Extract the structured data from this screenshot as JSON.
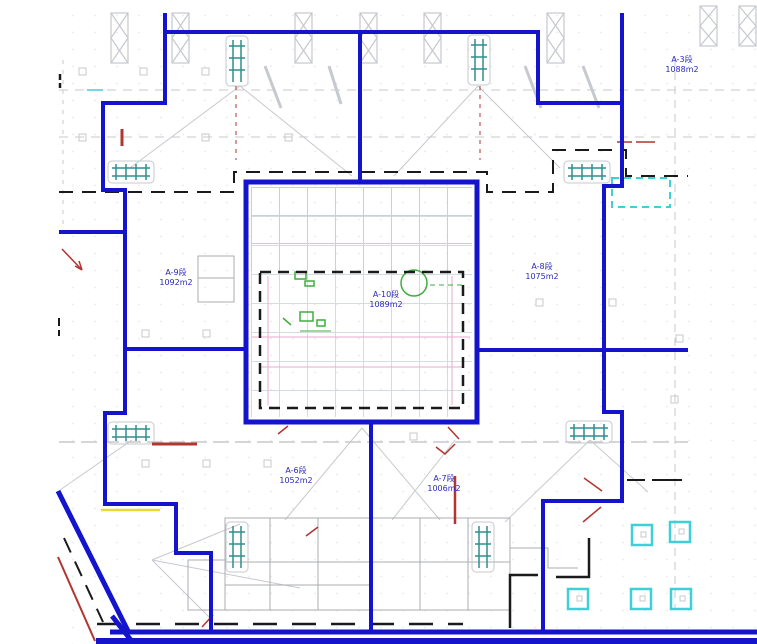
{
  "drawing": {
    "zones": {
      "a3": {
        "name": "A-3段",
        "area": "1088m2"
      },
      "a6": {
        "name": "A-6段",
        "area": "1052m2"
      },
      "a7": {
        "name": "A-7段",
        "area": "1006m2"
      },
      "a8": {
        "name": "A-8段",
        "area": "1075m2"
      },
      "a9": {
        "name": "A-9段",
        "area": "1092m2"
      },
      "a10": {
        "name": "A-10段",
        "area": "1089m2"
      }
    },
    "colors": {
      "boundary-blue": "#1414cd",
      "label-blue": "#2a2ab8",
      "dash-black": "#1a1a1a",
      "grid-gray": "#c6c9ce",
      "building-gray": "#a9acb1",
      "scaffold-teal": "#2e8f8f",
      "marker-cyan": "#3ed0d6",
      "mark-red": "#b13530",
      "highlight-yellow": "#e8d93a",
      "landscape-green": "#3fae3f",
      "accent-pink": "#eaaacf"
    }
  }
}
